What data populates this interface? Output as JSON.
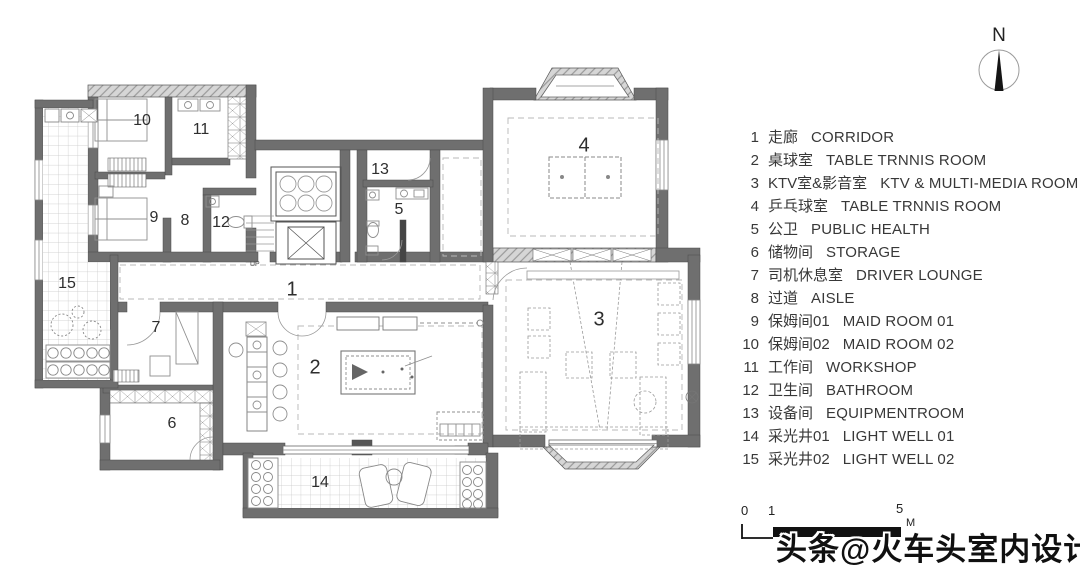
{
  "legend": {
    "items": [
      {
        "num": "1",
        "zh": "走廊",
        "en": "CORRIDOR"
      },
      {
        "num": "2",
        "zh": "桌球室",
        "en": "TABLE TRNNIS ROOM"
      },
      {
        "num": "3",
        "zh": "KTV室&影音室",
        "en": "KTV & MULTI-MEDIA ROOM"
      },
      {
        "num": "4",
        "zh": "乒乓球室",
        "en": "TABLE TRNNIS ROOM"
      },
      {
        "num": "5",
        "zh": "公卫",
        "en": "PUBLIC HEALTH"
      },
      {
        "num": "6",
        "zh": "储物间",
        "en": "STORAGE"
      },
      {
        "num": "7",
        "zh": "司机休息室",
        "en": "DRIVER LOUNGE"
      },
      {
        "num": "8",
        "zh": "过道",
        "en": "AISLE"
      },
      {
        "num": "9",
        "zh": "保姆间01",
        "en": "MAID ROOM 01"
      },
      {
        "num": "10",
        "zh": "保姆间02",
        "en": "MAID ROOM 02"
      },
      {
        "num": "11",
        "zh": "工作间",
        "en": "WORKSHOP"
      },
      {
        "num": "12",
        "zh": "卫生间",
        "en": "BATHROOM"
      },
      {
        "num": "13",
        "zh": "设备间",
        "en": "EQUIPMENTROOM"
      },
      {
        "num": "14",
        "zh": "采光井01",
        "en": "LIGHT WELL 01"
      },
      {
        "num": "15",
        "zh": "采光井02",
        "en": "LIGHT WELL 02"
      }
    ]
  },
  "floor_plan": {
    "stair_label": "UP",
    "rooms": [
      {
        "id": "1",
        "x": 292,
        "y": 290,
        "major": true
      },
      {
        "id": "2",
        "x": 315,
        "y": 368,
        "major": true
      },
      {
        "id": "3",
        "x": 599,
        "y": 320,
        "major": true
      },
      {
        "id": "4",
        "x": 584,
        "y": 146,
        "major": true
      },
      {
        "id": "5",
        "x": 399,
        "y": 210,
        "major": false
      },
      {
        "id": "6",
        "x": 172,
        "y": 424,
        "major": false
      },
      {
        "id": "7",
        "x": 156,
        "y": 328,
        "major": false
      },
      {
        "id": "8",
        "x": 185,
        "y": 221,
        "major": false
      },
      {
        "id": "9",
        "x": 154,
        "y": 218,
        "major": false
      },
      {
        "id": "10",
        "x": 142,
        "y": 121,
        "major": false
      },
      {
        "id": "11",
        "x": 201,
        "y": 130,
        "major": false
      },
      {
        "id": "12",
        "x": 221,
        "y": 223,
        "major": false
      },
      {
        "id": "13",
        "x": 380,
        "y": 170,
        "major": false
      },
      {
        "id": "14",
        "x": 320,
        "y": 483,
        "major": false
      },
      {
        "id": "15",
        "x": 67,
        "y": 284,
        "major": false
      }
    ]
  },
  "compass": {
    "label": "N"
  },
  "scale_bar": {
    "zero": "0",
    "one": "1",
    "five": "5",
    "unit": "M"
  },
  "watermark": {
    "text": "头条@火车头室内设计"
  }
}
